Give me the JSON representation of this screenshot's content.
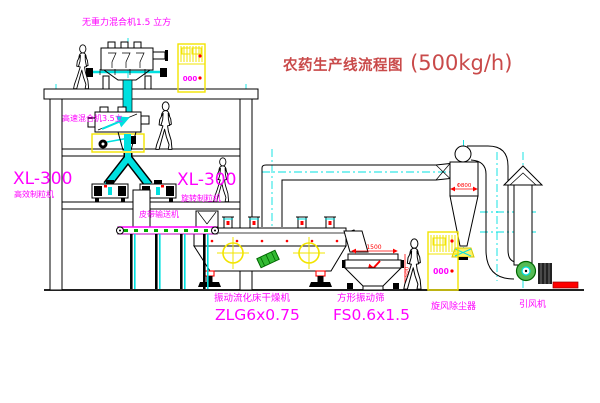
{
  "title": {
    "text": "农药生产线流程图",
    "capacity": "(500kg/h)"
  },
  "equipment_labels": {
    "zero_gravity_mixer": "无重力混合机1.5 立方",
    "high_speed_mixer": "高速混合机3.5立",
    "granulator_left": {
      "model": "XL-300",
      "name": "高效制粒机"
    },
    "granulator_right": {
      "model": "XL-300",
      "name": "旋转制粒机"
    },
    "belt_conveyor": "皮带输送机",
    "fluid_bed_dryer": {
      "name": "振动流化床干燥机",
      "model": "ZLG6x0.75"
    },
    "vibrating_sieve": {
      "name": "方形振动筛",
      "model": "FS0.6x1.5"
    },
    "cyclone": "旋风除尘器",
    "induced_draft_fan": "引风机"
  },
  "dimensions": {
    "cyclone_diameter": "Φ800",
    "sieve_length": "1500",
    "sieve_height": "500"
  },
  "control_cabinets": {
    "display": "000"
  },
  "colors": {
    "label": "#ff00ff",
    "title": "#c94a4a",
    "dimension": "#ff0000",
    "centerline": "#00e0e0",
    "cabinet": "#f2e400",
    "machine_green": "#33bb33"
  }
}
